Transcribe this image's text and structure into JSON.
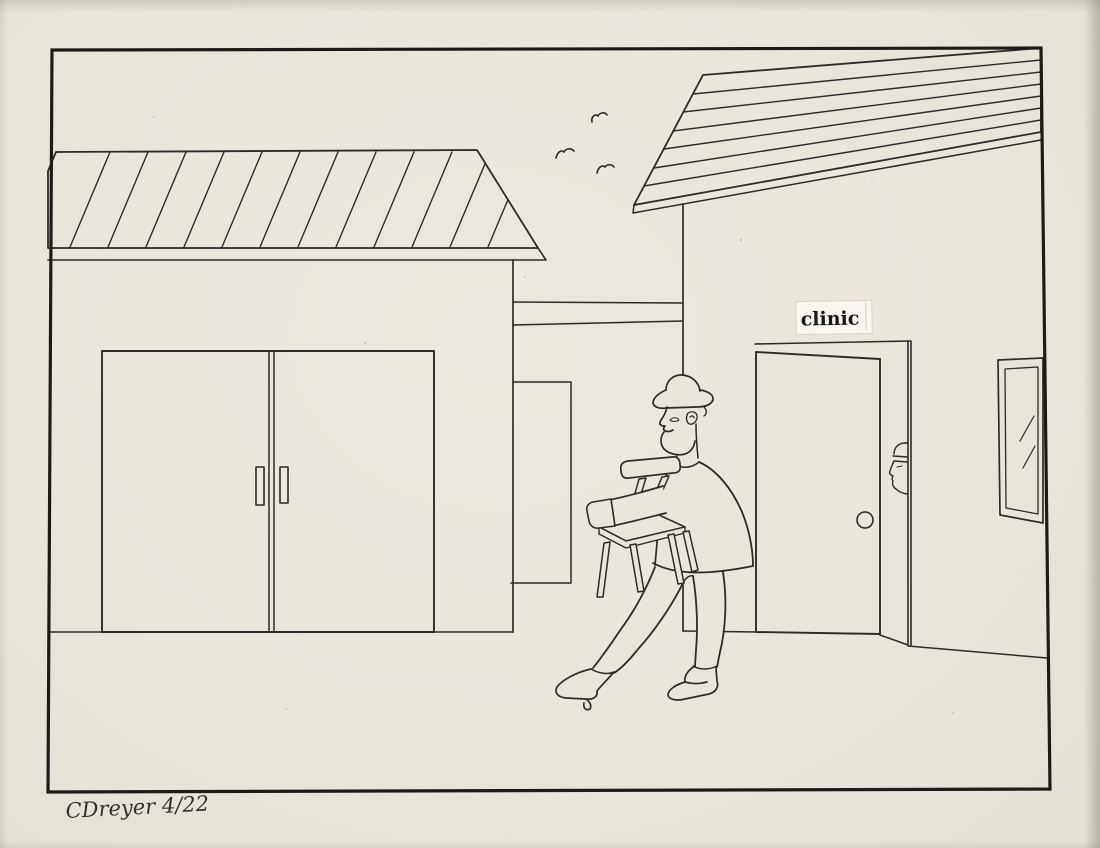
{
  "drawing": {
    "clinic_sign": {
      "text": "clinic"
    },
    "signature": {
      "text": "CDreyer 4/22"
    },
    "palette": {
      "paper": "#e9e5db",
      "ink": "#2d2b28",
      "frame_border": "#1c1b19",
      "sign_background": "#f8f6ee",
      "paper_edge_shadow": "#8c867a"
    },
    "scene_objects": [
      "left-building",
      "striped-slanted-roof",
      "double-doors",
      "door-handles",
      "connecting-wall",
      "background-doorway",
      "right-building",
      "plank-roof",
      "clinic-sign",
      "open-door",
      "doorknob",
      "peeking-person",
      "window",
      "man-carrying-chair",
      "fedora-hat",
      "chair",
      "flying-birds",
      "artist-signature"
    ]
  }
}
